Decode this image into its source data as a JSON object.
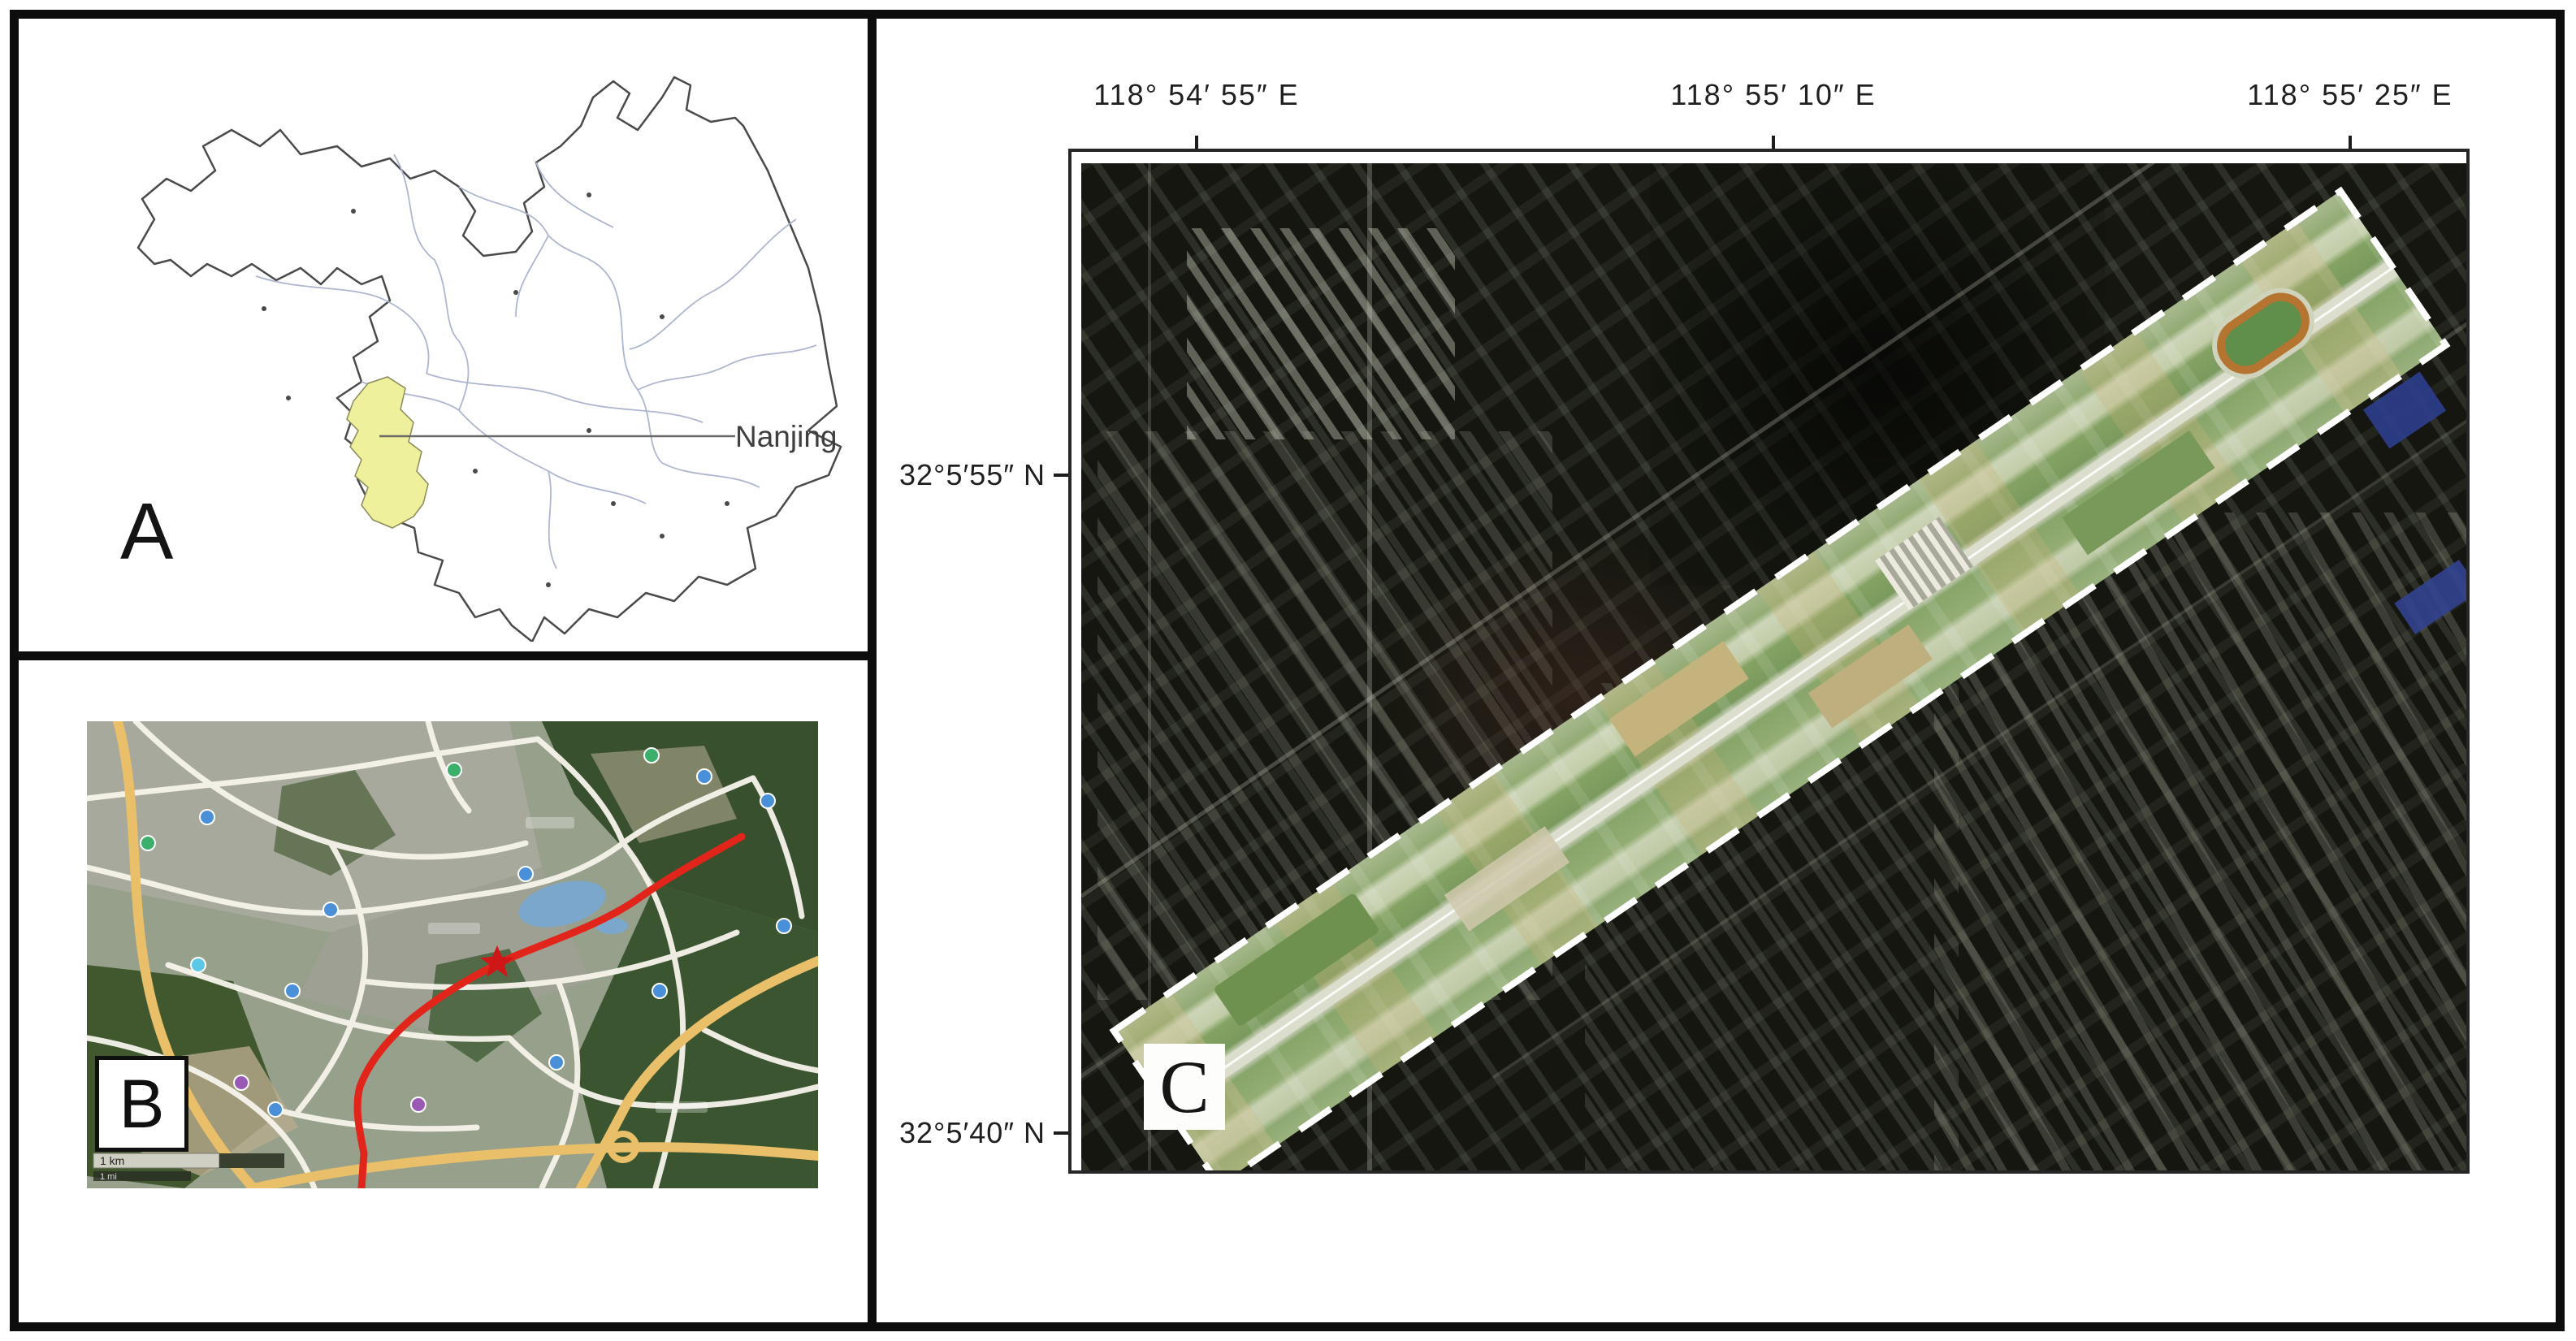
{
  "figure": {
    "panel_a": {
      "letter": "A",
      "callout_label": "Nanjing"
    },
    "panel_b": {
      "letter": "B",
      "scale_primary": "1 km",
      "scale_secondary": "1 mi"
    },
    "panel_c": {
      "letter": "C",
      "longitude_labels": [
        "118° 54′ 55″ E",
        "118° 55′ 10″ E",
        "118° 55′ 25″ E"
      ],
      "latitude_labels": [
        "32°5′55″ N",
        "32°5′40″ N"
      ]
    },
    "colors": {
      "highlight_region": "#eef09b",
      "route_line": "#e1251b",
      "corridor_dash": "#ffffff",
      "frame": "#0d0d0d"
    }
  }
}
